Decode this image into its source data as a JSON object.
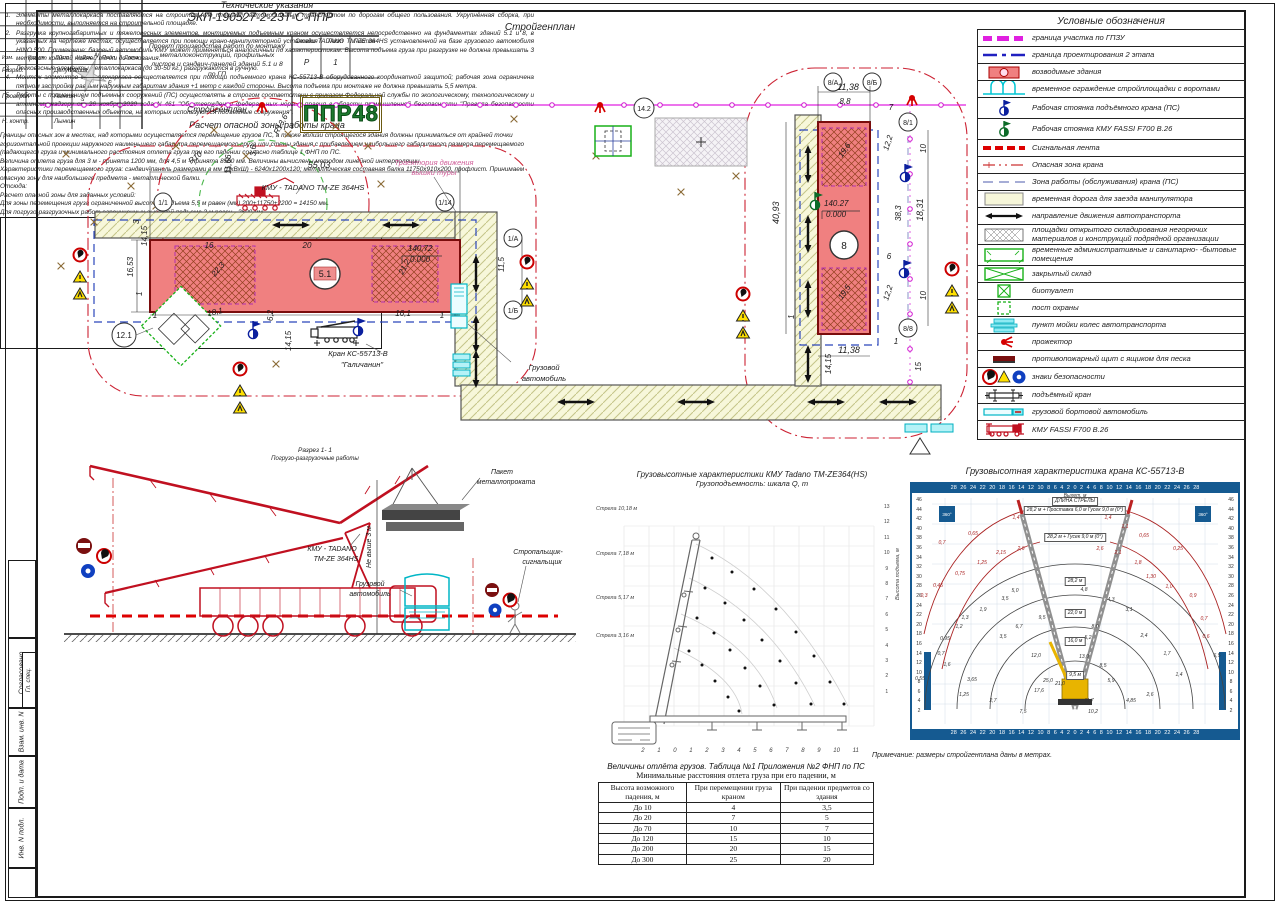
{
  "sheet": {
    "title": "Стройгенплан"
  },
  "stamp_strip": {
    "items": [
      "Согласовано",
      "Гл. спец.",
      "Взам. инв. N",
      "Подп. и дата",
      "Инв. N подл."
    ]
  },
  "legend": {
    "title": "Условные обозначения",
    "items": [
      "граница участка по ГПЗУ",
      "граница проектирования 2 этапа",
      "возводимые здания",
      "временное ограждение стройплощадки с воротами",
      "Рабочая стоянка подъёмного крана (ПС)",
      "Рабочая стоянка КМУ FASSI F700 B.26",
      "Сигнальная лента",
      "Опасная зона крана",
      "Зона работы (обслуживания) крана (ПС)",
      "временная дорога для заезда манипулятора",
      "направление движения автотранспорта",
      "площадки открытого складирования негорючих материалов и конструкций подрядной организации",
      "временные административные и санитарно- -бытовые помещения",
      "закрытый склад",
      "биотуалет",
      "пост охраны",
      "пункт мойки колес автотранспорта",
      "прожектор",
      "противопожарный щит с ящиком для песка",
      "знаки безопасности",
      "подъёмный кран",
      "грузовой бортовой автомобиль",
      "КМУ FASSI F700 B.26"
    ]
  },
  "plan": {
    "grid": {
      "g11": "1/1",
      "g114": "1/14",
      "g1a": "1/А",
      "g1b": "1/Б",
      "g121": "12.1",
      "g142": "14.2",
      "g8a": "8/А",
      "g8b": "8/Б",
      "g81": "8/1",
      "g88": "8/8"
    },
    "marks": {
      "b51": "5.1",
      "b8": "8",
      "elev51a": "140,72",
      "elev51b": "0.000",
      "elev8a": "140.27",
      "elev8b": "0.000"
    },
    "labels": {
      "kmu": "КМУ - TADANO TM-ZE 364HS",
      "traj1": "Траектория движения",
      "traj2": "вышки туры",
      "crane1": "Кран КС-55713-В",
      "crane2": "\"Галичанин\"",
      "truck1": "Грузовой",
      "truck2": "автомобиль"
    },
    "dims": {
      "w5503": "55,03",
      "r136": "R13,6",
      "r10": "R10",
      "v36": "3,6",
      "v1166": "11,66",
      "s16": "16",
      "s20": "20",
      "l3": "3",
      "l1653": "16,53",
      "l1415": "14,15",
      "l1": "1",
      "b1": "1",
      "b181": "18,1",
      "b62": "6,2",
      "b1415": "14,15",
      "b161": "16,1",
      "b1r": "1",
      "r115": "11,5",
      "d223": "22,3",
      "d212": "21,2",
      "w1138": "11,38",
      "w88": "8,8",
      "w7": "7",
      "e122a": "12,2",
      "e10a": "10",
      "h4093": "40,93",
      "e383": "38,3",
      "e1831": "18,31",
      "e6": "6",
      "e122b": "12,2",
      "e10b": "10",
      "eb1": "1",
      "eb1138": "11,38",
      "eb1r": "1",
      "eb1415": "14,15",
      "eb15": "15",
      "d196": "19,6",
      "d195": "19,5"
    }
  },
  "section": {
    "c1": "Разрез 1- 1",
    "c2": "Погрузо-разгрузочные работы",
    "kmu1": "КМУ - TADANO",
    "kmu2": "TM-ZE 364HS",
    "pack1": "Пакет",
    "pack2": "металлопроката",
    "h3": "Не выше 3 м",
    "truck1": "Грузовой",
    "truck2": "автомобиль",
    "sig1": "Стропальщик-",
    "sig2": "сигнальщик"
  },
  "notes": {
    "title": "Технические указания",
    "items": [
      "Элементы металлокаркаса поставляются на строительную площадку автомобильным транспортом по дорогам общего пользования. Укрупнённая сборка, при необходимости, выполняется на строительной площадке.",
      "Разгрузка крупногабаритных и тяжеловесных элементов, монтируемых подъемным краном осуществляется непосредственно на фундаментах зданий 5.1 и 8, в указанных на чертеже местах, осуществляется при помощи крано-манипуляторной установки TADANO TM-ZE 364HS установленной на базе грузового автомобиля HINO 500. Примечание: базовый автомобиль КМУ может применяться аналогичный по характеристикам. Высота подъема груза при разгрузке не должна превышать 3 метра от крайней нижней точки до основания.",
      "Легковесные элементы металлокаркаса (до 30-50 кг.) разгружаются в ручную.",
      "Монтаж элементов металлокаркаса осуществляется при помощи подъемного крана КС-55713-В оборудованного координатной защитой; рабочая зона ограничена пятном застройки равным наружным габаритам здания +1 метр с каждой стороны. Высота подъема при монтаже не должна превышать 5,5 метра.",
      "Работы с применением подъемных сооружений (ПС) осуществлять в строгом соответствии с приказом Федеральной службы по экологическому, технологическому и атомному надзору от 26 ноября 2020 года N 461 \"Об утверждении федеральных норм и правил в области промышленной безопасности \"Правила безопасности опасных производственных объектов, на которых используются подъемные сооружения\"."
    ],
    "calc_title": "Расчет опасной зоны работы крана",
    "calc": [
      "Границы опасных зон в местах, над которыми осуществляется перемещение грузов ПС, а также вблизи строящегося здания должны приниматься от крайней точки горизонтальной проекции наружного наименьшего габарита перемещаемого груза или стены здания с прибавлением наибольшего габаритного размера перемещаемого (падающего) груза и минимального расстояния отлета груза при его падении согласно таблице 1 ФНП по ПС.",
      "Величина отлета груза для 3 м - принята 1200 мм, для 4,5 м - принята 8560 мм. Величины вычислены методом линейной интерполяции.",
      "Характеристики перемещаемого груза: сэндвич-панель размерами в мм (ДхВхШ) - 6240х1200х120; металлическая составная балка 11750х910х200, профлист. Принимаем опасную зону для наибольшего предмета - металлической балки.",
      "Отсюда:",
      "Расчет опасной зоны для заданных условий:",
      "Для зоны перемещения груза ограниченной высотой подъема 5,5 м равен (мм) 200+11750+2200 = 14150 мм.",
      "Для погрузо-разгрузочных работ ограниченных высотой подъема 3 м равен - 3600 мм."
    ]
  },
  "offset_table": {
    "title1": "Величины отлёта грузов. Таблица №1 Приложения №2 ФНП по ПС",
    "title2": "Минимальные расстояния отлета груза при его падении, м",
    "headers": [
      "Высота возможного падения, м",
      "При перемещении груза краном",
      "При падении предметов со здания"
    ],
    "rows": [
      [
        "До 10",
        "4",
        "3,5"
      ],
      [
        "До 20",
        "7",
        "5"
      ],
      [
        "До 70",
        "10",
        "7"
      ],
      [
        "До 120",
        "15",
        "10"
      ],
      [
        "До 200",
        "20",
        "15"
      ],
      [
        "До 300",
        "25",
        "20"
      ]
    ]
  },
  "chart_mid": {
    "t1": "Грузовысотные характеристики КМУ Tadano TM-ZE364(HS)",
    "t2": "Грузоподъемность: шкала Q, т",
    "booms": [
      "Стрела 10,18 м",
      "Стрела 7,18 м",
      "Стрела 5,17 м",
      "Стрела 3,16 м"
    ],
    "x_ticks": "2 1 0 1 2 3 4 5 6 7 8 9 10 11",
    "y_label": "Высота подъема, м",
    "y_ticks": "13\n12\n11\n10\n9\n8\n7\n6\n5\n4\n3\n2\n1",
    "points": [
      {
        "x": 116,
        "y": 62
      },
      {
        "x": 136,
        "y": 76
      },
      {
        "x": 158,
        "y": 93
      },
      {
        "x": 180,
        "y": 113
      },
      {
        "x": 200,
        "y": 136
      },
      {
        "x": 218,
        "y": 160
      },
      {
        "x": 234,
        "y": 186
      },
      {
        "x": 248,
        "y": 208
      },
      {
        "x": 109,
        "y": 92
      },
      {
        "x": 129,
        "y": 107
      },
      {
        "x": 148,
        "y": 124
      },
      {
        "x": 166,
        "y": 144
      },
      {
        "x": 184,
        "y": 165
      },
      {
        "x": 200,
        "y": 187
      },
      {
        "x": 215,
        "y": 208
      },
      {
        "x": 101,
        "y": 122
      },
      {
        "x": 118,
        "y": 137
      },
      {
        "x": 134,
        "y": 154
      },
      {
        "x": 149,
        "y": 172
      },
      {
        "x": 164,
        "y": 190
      },
      {
        "x": 178,
        "y": 209
      },
      {
        "x": 93,
        "y": 155
      },
      {
        "x": 106,
        "y": 169
      },
      {
        "x": 119,
        "y": 185
      },
      {
        "x": 132,
        "y": 201
      },
      {
        "x": 143,
        "y": 215
      }
    ]
  },
  "chart_right": {
    "title": "Грузовысотная характеристика крана КС-55713-В",
    "top_axis": "Вылет, м",
    "boom_len": "ДЛИНА СТРЕЛЫ",
    "cfg": [
      "28,2 м + Проставка 6,0 м  Гусек 9,0 м (0°)",
      "28,2 м + Гусек 9,0 м (0°)",
      "28,2 м",
      "22,0 м",
      "16,0 м",
      "9,5 м"
    ],
    "ticks_h": "28 26 24 22 20 18 16 14 12 10 8 6 4 2 0 2 4 6 8 10 12 14 16 18 20 22 24 26 28",
    "ticks_v": "46\n44\n42\n40\n38\n36\n34\n32\n30\n28\n26\n24\n22\n20\n18\n16\n14\n12\n10\n8\n6\n4\n2",
    "corner": "360°",
    "vals": [
      {
        "t": "1,4",
        "x": 104,
        "y": 34,
        "c": "r"
      },
      {
        "t": "0,65",
        "x": 61,
        "y": 50,
        "c": "r"
      },
      {
        "t": "0,7",
        "x": 30,
        "y": 59,
        "c": "r"
      },
      {
        "t": "2,6",
        "x": 109,
        "y": 65,
        "c": "r"
      },
      {
        "t": "2,15",
        "x": 89,
        "y": 69,
        "c": "r"
      },
      {
        "t": "1,25",
        "x": 70,
        "y": 79,
        "c": "r"
      },
      {
        "t": "0,75",
        "x": 48,
        "y": 90,
        "c": "r"
      },
      {
        "t": "0,45",
        "x": 26,
        "y": 102,
        "c": "r"
      },
      {
        "t": "0,3",
        "x": 12,
        "y": 112,
        "c": "r"
      },
      {
        "t": "1,4",
        "x": 196,
        "y": 34,
        "c": "r"
      },
      {
        "t": "1,1",
        "x": 213,
        "y": 43,
        "c": "r"
      },
      {
        "t": "0,65",
        "x": 232,
        "y": 52,
        "c": "r"
      },
      {
        "t": "0,25",
        "x": 266,
        "y": 65,
        "c": "r"
      },
      {
        "t": "2,6",
        "x": 188,
        "y": 65,
        "c": "r"
      },
      {
        "t": "2,1",
        "x": 206,
        "y": 69,
        "c": "r"
      },
      {
        "t": "1,8",
        "x": 226,
        "y": 79,
        "c": "r"
      },
      {
        "t": "1,30",
        "x": 239,
        "y": 93,
        "c": "r"
      },
      {
        "t": "1,0",
        "x": 257,
        "y": 103,
        "c": "r"
      },
      {
        "t": "0,9",
        "x": 281,
        "y": 112,
        "c": "r"
      },
      {
        "t": "0,7",
        "x": 292,
        "y": 135,
        "c": "r"
      },
      {
        "t": "0,6",
        "x": 294,
        "y": 153,
        "c": "r"
      },
      {
        "t": "5,0",
        "x": 103,
        "y": 107
      },
      {
        "t": "3,5",
        "x": 93,
        "y": 115
      },
      {
        "t": "1,9",
        "x": 71,
        "y": 126
      },
      {
        "t": "1,3",
        "x": 53,
        "y": 134
      },
      {
        "t": "1,2",
        "x": 47,
        "y": 143
      },
      {
        "t": "0,95",
        "x": 33,
        "y": 155
      },
      {
        "t": "0,7",
        "x": 29,
        "y": 170
      },
      {
        "t": "0,55",
        "x": 8,
        "y": 195
      },
      {
        "t": "1,6",
        "x": 35,
        "y": 181
      },
      {
        "t": "3,65",
        "x": 60,
        "y": 196
      },
      {
        "t": "1,25",
        "x": 52,
        "y": 211
      },
      {
        "t": "2,7",
        "x": 81,
        "y": 217
      },
      {
        "t": "7,5",
        "x": 111,
        "y": 228
      },
      {
        "t": "6,7",
        "x": 107,
        "y": 143
      },
      {
        "t": "3,5",
        "x": 91,
        "y": 153
      },
      {
        "t": "9,5",
        "x": 130,
        "y": 134
      },
      {
        "t": "12,0",
        "x": 124,
        "y": 172
      },
      {
        "t": "17,6",
        "x": 127,
        "y": 207
      },
      {
        "t": "25,0",
        "x": 136,
        "y": 197
      },
      {
        "t": "21,0",
        "x": 148,
        "y": 200
      },
      {
        "t": "4,3",
        "x": 199,
        "y": 116
      },
      {
        "t": "3,1",
        "x": 217,
        "y": 126
      },
      {
        "t": "2,4",
        "x": 232,
        "y": 152
      },
      {
        "t": "1,7",
        "x": 255,
        "y": 170
      },
      {
        "t": "1,4",
        "x": 267,
        "y": 191
      },
      {
        "t": "2,6",
        "x": 238,
        "y": 211
      },
      {
        "t": "4,85",
        "x": 219,
        "y": 217
      },
      {
        "t": "5,9",
        "x": 199,
        "y": 197
      },
      {
        "t": "8,5",
        "x": 191,
        "y": 182
      },
      {
        "t": "8,0",
        "x": 183,
        "y": 143
      },
      {
        "t": "5,2",
        "x": 176,
        "y": 154
      },
      {
        "t": "13,0",
        "x": 172,
        "y": 173
      },
      {
        "t": "11,7",
        "x": 177,
        "y": 217
      },
      {
        "t": "10,2",
        "x": 181,
        "y": 228
      },
      {
        "t": "4,8",
        "x": 172,
        "y": 106
      },
      {
        "t": "6,5",
        "x": 305,
        "y": 172
      }
    ]
  },
  "titleblock": {
    "note": "Примечание: размеры стройгенплана даны в метрах.",
    "doc": "ЭКП-190527-2-23Т-С-ППР",
    "cols": [
      "Изм.",
      "Кол.уч",
      "Лист",
      "№Док.",
      "Подп.",
      "Дата"
    ],
    "r1": "Разраб.",
    "n1": "Депутатов",
    "r2": "Проверил",
    "n2": "Лынкин",
    "r3": "Н. контр.",
    "n3": "Лынкин",
    "project": "Проект производства работ по монтажу металлоконструкций, профильных листов и сэндвич-панелей зданий 5.1 и 8 по ГП",
    "stage_h": "Стадия",
    "sheet_h": "Лист",
    "sheets_h": "Листов",
    "stage": "Р",
    "sheet": "1",
    "name": "Стройгенплан",
    "logo": "ППР48"
  }
}
